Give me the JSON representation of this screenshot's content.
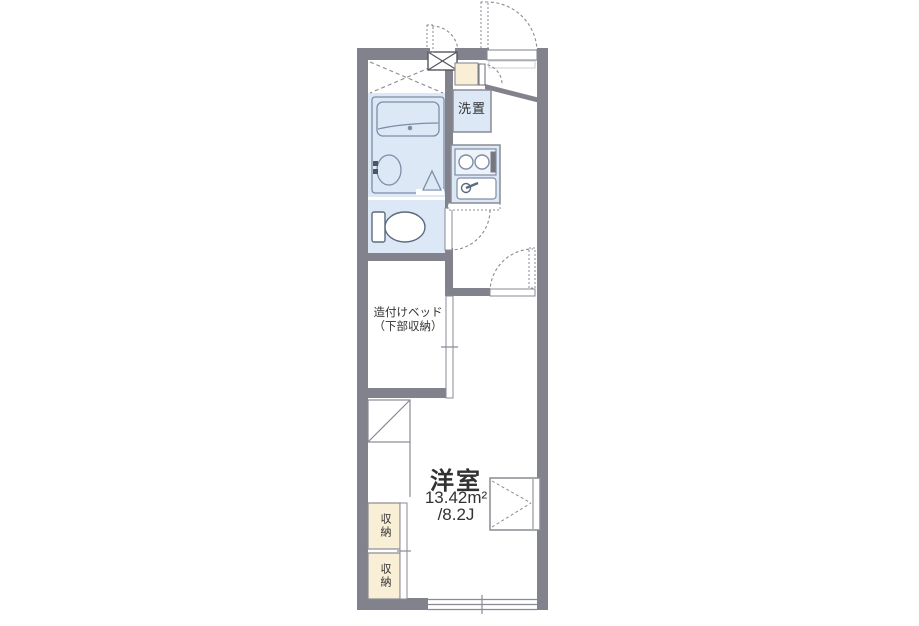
{
  "plan": {
    "rooms": {
      "western_room": {
        "label": "洋室",
        "area_m2": "13.42m²",
        "area_tatami": "/8.2J"
      },
      "washing_machine": {
        "label": "洗置"
      },
      "built_in_bed": {
        "line1": "造付けベッド",
        "line2": "（下部収納）"
      },
      "storage_upper": {
        "label": "収納"
      },
      "storage_lower": {
        "label": "収納"
      }
    },
    "colors": {
      "wall": "#82828c",
      "wet_area_fill": "#dce8f5",
      "storage_fill": "#f9efd7",
      "line": "#8a8a94",
      "fixture_line": "#7d8da6",
      "text": "#323232"
    }
  }
}
